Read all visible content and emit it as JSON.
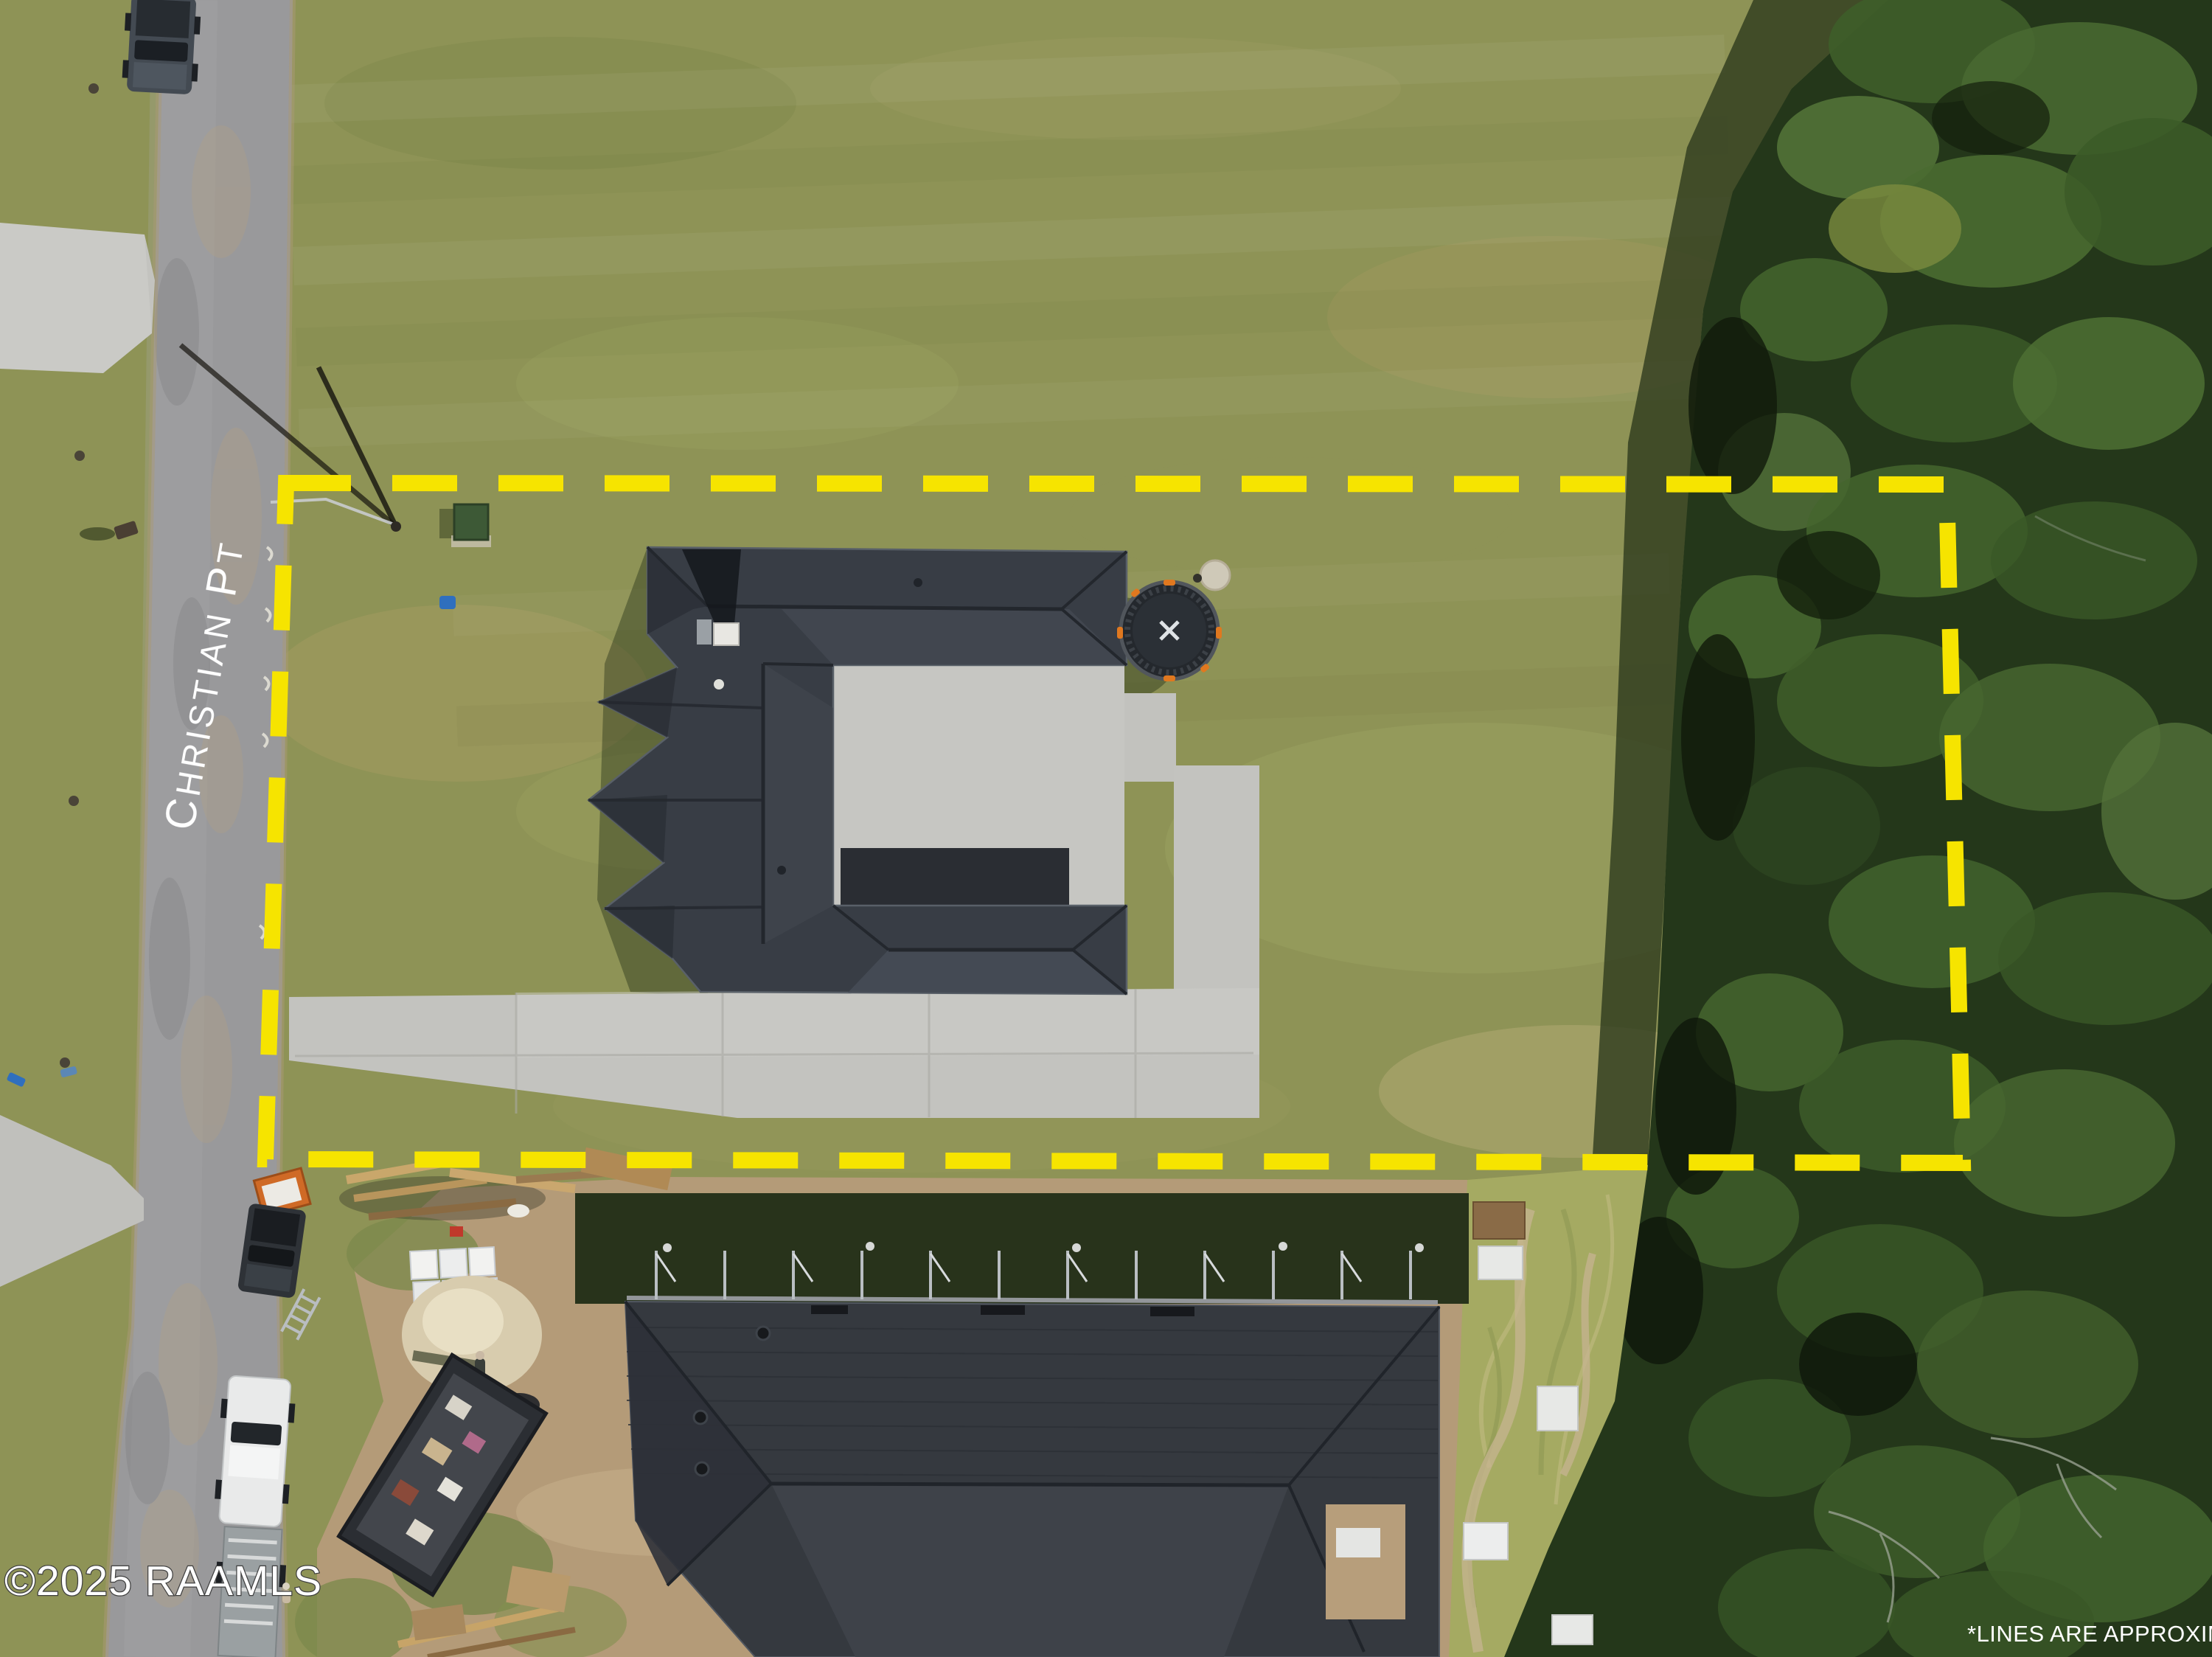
{
  "overlays": {
    "street_name": "CHRISTIAN PT",
    "street_name_parts": {
      "c": "C",
      "hristian": "HRISTIAN",
      "p": "P",
      "t": "T"
    },
    "watermark": "©2025 RAAMLS",
    "disclaimer": "*LINES ARE APPROXIMATE"
  },
  "colors": {
    "boundary_yellow": "#f6e400",
    "overlay_text": "#ffffff",
    "watermark_outline": "#3f3f3f",
    "lawn_green": "#8e9356",
    "road_gray": "#99999b",
    "concrete": "#c6c6c2",
    "roof_dark": "#383d45",
    "forest_green": "#24371a",
    "dirt_tan": "#b49b78",
    "trampoline_black": "#24282d"
  }
}
